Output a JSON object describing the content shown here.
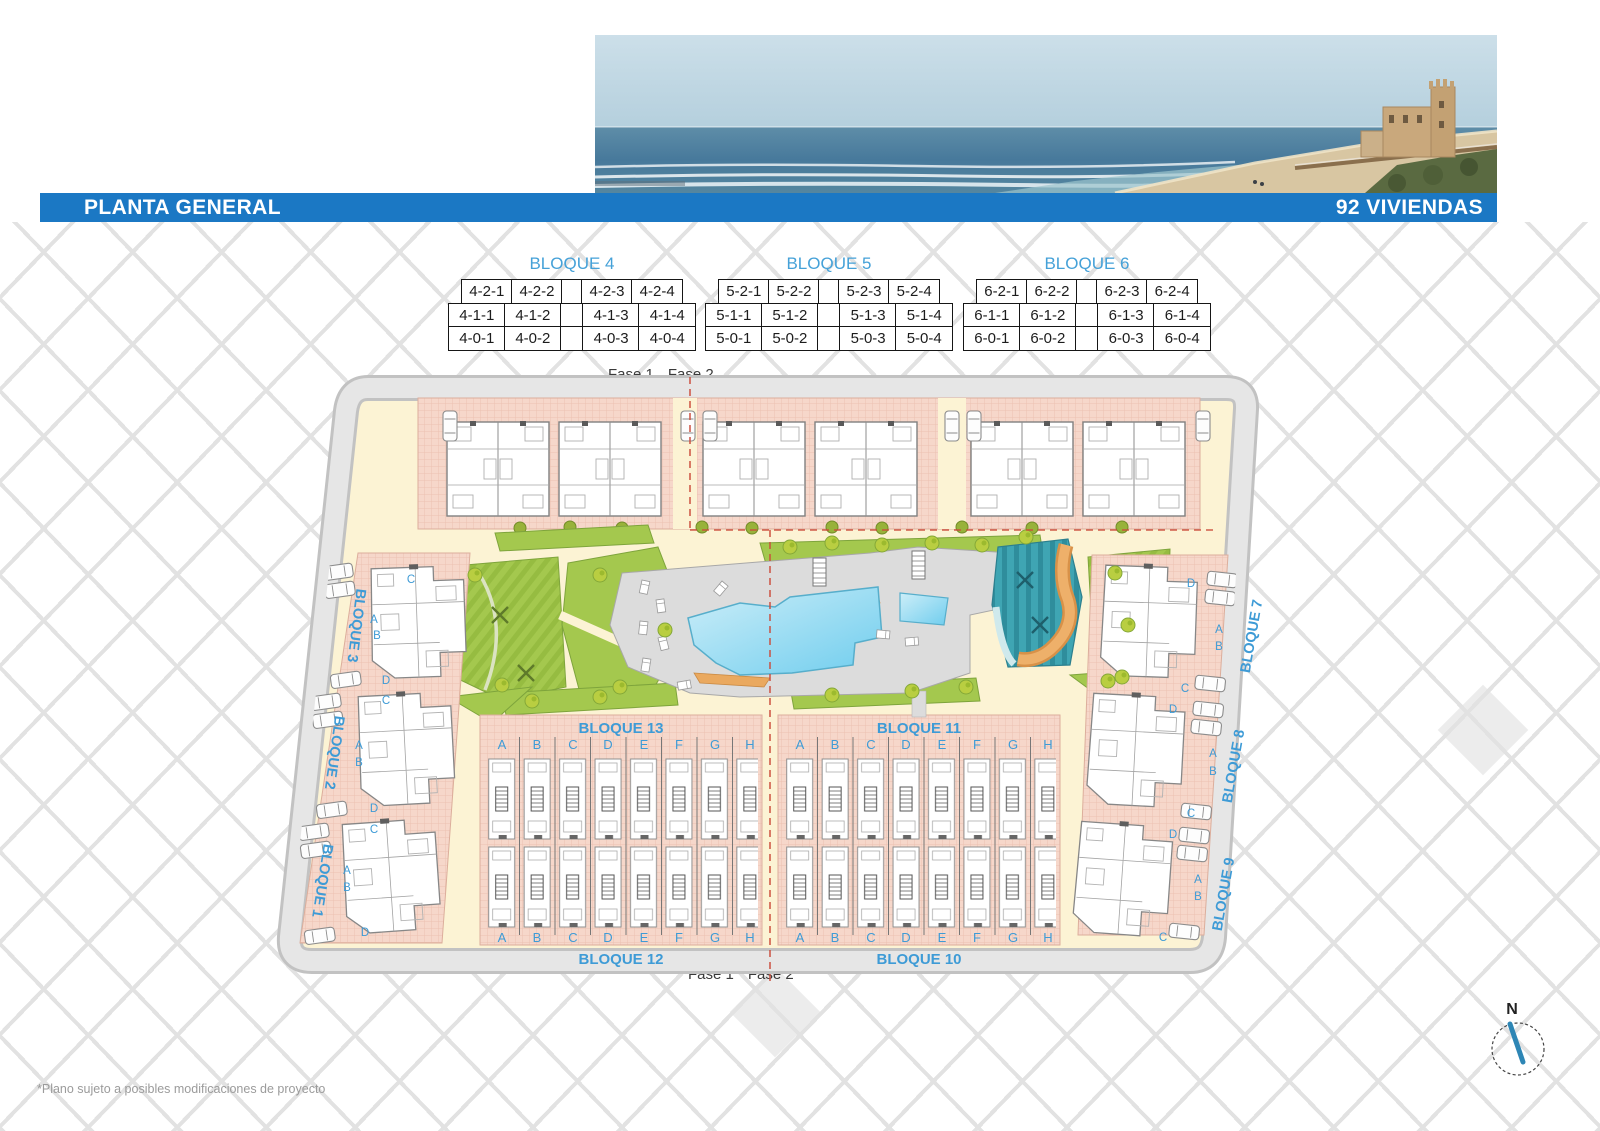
{
  "header": {
    "title": "PLANTA GENERAL",
    "badge": "92 VIVIENDAS"
  },
  "legend_tables": [
    {
      "title": "BLOQUE 4",
      "rows": [
        [
          "4-2-1",
          "4-2-2",
          "",
          "4-2-3",
          "4-2-4"
        ],
        [
          "4-1-1",
          "4-1-2",
          "",
          "4-1-3",
          "4-1-4"
        ],
        [
          "4-0-1",
          "4-0-2",
          "",
          "4-0-3",
          "4-0-4"
        ]
      ]
    },
    {
      "title": "BLOQUE 5",
      "rows": [
        [
          "5-2-1",
          "5-2-2",
          "",
          "5-2-3",
          "5-2-4"
        ],
        [
          "5-1-1",
          "5-1-2",
          "",
          "5-1-3",
          "5-1-4"
        ],
        [
          "5-0-1",
          "5-0-2",
          "",
          "5-0-3",
          "5-0-4"
        ]
      ]
    },
    {
      "title": "BLOQUE 6",
      "rows": [
        [
          "6-2-1",
          "6-2-2",
          "",
          "6-2-3",
          "6-2-4"
        ],
        [
          "6-1-1",
          "6-1-2",
          "",
          "6-1-3",
          "6-1-4"
        ],
        [
          "6-0-1",
          "6-0-2",
          "",
          "6-0-3",
          "6-0-4"
        ]
      ]
    }
  ],
  "phase_labels": {
    "top_left": "Fase 1",
    "top_right": "Fase 2",
    "bottom_left": "Fase 1",
    "bottom_right": "Fase 2"
  },
  "plan": {
    "row_blocks": [
      {
        "name": "BLOQUE 13",
        "letters": [
          "A",
          "B",
          "C",
          "D",
          "E",
          "F",
          "G",
          "H"
        ]
      },
      {
        "name": "BLOQUE 11",
        "letters": [
          "A",
          "B",
          "C",
          "D",
          "E",
          "F",
          "G",
          "H"
        ]
      },
      {
        "name": "BLOQUE 12",
        "letters": [
          "A",
          "B",
          "C",
          "D",
          "E",
          "F",
          "G",
          "H"
        ]
      },
      {
        "name": "BLOQUE 10",
        "letters": [
          "A",
          "B",
          "C",
          "D",
          "E",
          "F",
          "G",
          "H"
        ]
      }
    ],
    "left_blocks": [
      {
        "name": "BLOQUE 3",
        "letters": [
          "C",
          "A",
          "B",
          "D"
        ]
      },
      {
        "name": "BLOQUE 2",
        "letters": [
          "C",
          "A",
          "B",
          "D"
        ]
      },
      {
        "name": "BLOQUE 1",
        "letters": [
          "C",
          "A",
          "B",
          "D"
        ]
      }
    ],
    "right_blocks": [
      {
        "name": "BLOQUE 7",
        "letters": [
          "D",
          "A",
          "B",
          "C"
        ]
      },
      {
        "name": "BLOQUE 8",
        "letters": [
          "D",
          "A",
          "B",
          "C"
        ]
      },
      {
        "name": "BLOQUE 9",
        "letters": [
          "D",
          "A",
          "B",
          "C"
        ]
      }
    ],
    "compass_label": "N"
  },
  "footnote": "*Plano sujeto a posibles modificaciones de proyecto",
  "colors": {
    "accent_blue": "#1b78c4",
    "label_blue": "#3e9bd6",
    "phase_red": "#cb4b3b"
  }
}
